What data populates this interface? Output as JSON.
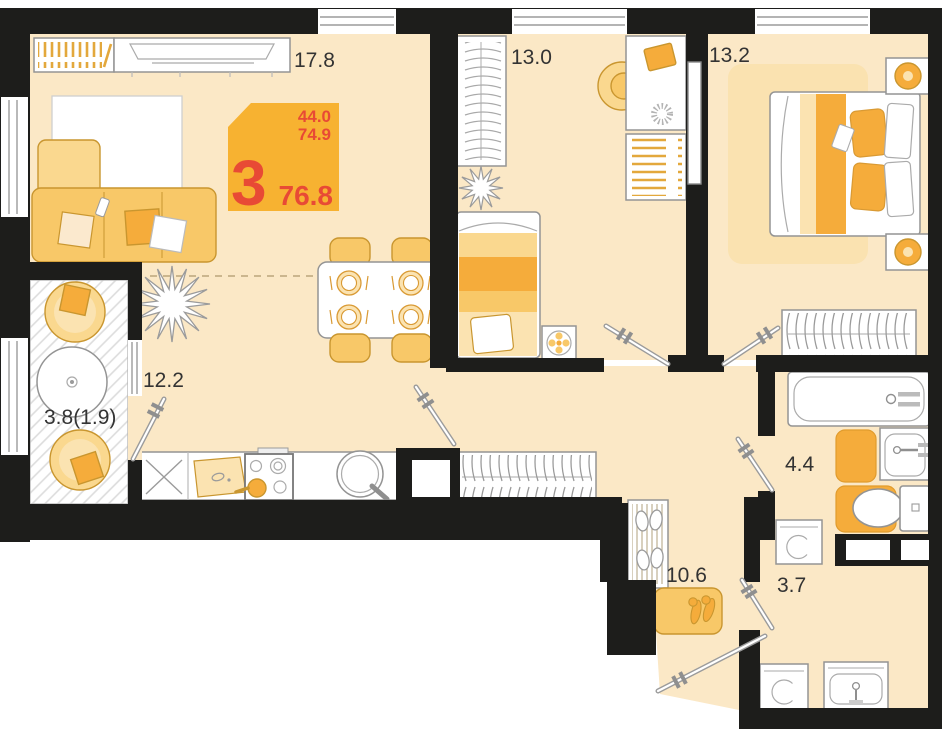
{
  "badge": {
    "rooms": "3",
    "line1": "44.0",
    "line2": "74.9",
    "total": "76.8"
  },
  "rooms": {
    "living": "17.8",
    "bedroom1": "13.0",
    "bedroom2": "13.2",
    "kitchen": "12.2",
    "balcony": "3.8(1.9)",
    "bathroom": "4.4",
    "laundry": "3.7",
    "hallway": "10.6"
  },
  "colors": {
    "wall": "#1D1D1B",
    "floor": "#FBE8C6",
    "accent": "#F5AC3B",
    "accent_light": "#F8C868",
    "accent_soft": "#FAD88F",
    "accent_pale": "#FBE3B1",
    "accent_stroke": "#C9962F",
    "outline": "#949494",
    "badge_bg": "#F7B231",
    "badge_text": "#E84A35",
    "label_text": "#333333"
  }
}
